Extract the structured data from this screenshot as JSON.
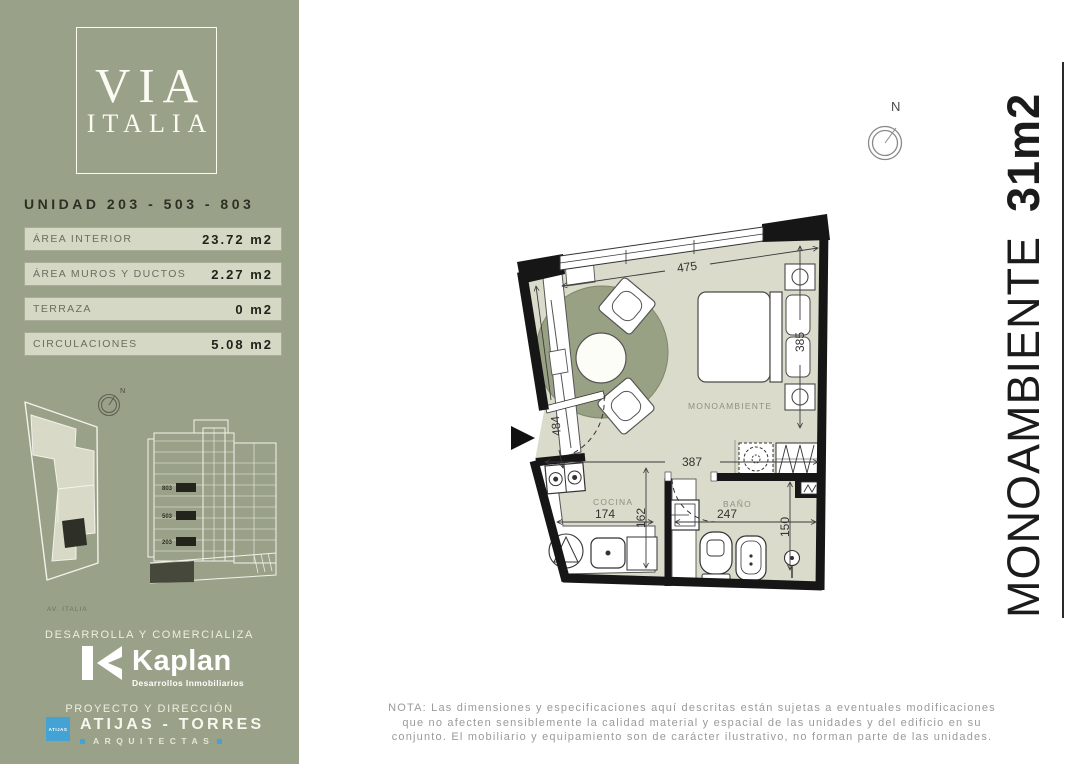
{
  "sidebar": {
    "logo": {
      "line1": "VIA",
      "line2": "ITALIA"
    },
    "unit_title": "UNIDAD 203 - 503 - 803",
    "areas": [
      {
        "label": "ÁREA INTERIOR",
        "value": "23.72 m2"
      },
      {
        "label": "ÁREA MUROS Y DUCTOS",
        "value": "2.27 m2"
      },
      {
        "label": "TERRAZA",
        "value": "0 m2"
      },
      {
        "label": "CIRCULACIONES",
        "value": "5.08 m2"
      }
    ],
    "site": {
      "compass": "N",
      "street": "AV. ITALIA"
    },
    "elevation": {
      "floors": [
        "803",
        "503",
        "203"
      ]
    },
    "developer": {
      "heading": "DESARROLLA Y COMERCIALIZA",
      "brand": "Kaplan",
      "tagline": "Desarrollos Inmobiliarios"
    },
    "architects": {
      "heading": "PROYECTO Y DIRECCIÓN",
      "badge": "ATIJAS",
      "name": "ATIJAS - TORRES",
      "subtitle": "ARQUITECTAS"
    }
  },
  "main": {
    "compass": "N",
    "side_title": {
      "text": "MONOAMBIENTE",
      "bold": "31m2"
    },
    "plan": {
      "rooms": {
        "main": "MONOAMBIENTE",
        "kitchen": "COCINA",
        "bath": "BAÑO"
      },
      "dims": {
        "top": "475",
        "left": "484",
        "mid": "387",
        "kitchen_w": "174",
        "kitchen_h": "162",
        "bath_w": "247",
        "bath_h": "150",
        "bed": "385"
      }
    },
    "note": {
      "line1": "NOTA: Las dimensiones y especificaciones aquí descritas están sujetas a eventuales modificaciones",
      "line2": "que no afecten sensiblemente la calidad material y espacial de las unidades y del edificio en su",
      "line3": "conjunto. El mobiliario y equipamiento son de carácter ilustrativo, no forman parte de las unidades."
    }
  },
  "colors": {
    "sidebar_green": "#9aa189",
    "row_bg": "#d6d8c6",
    "floor": "#dadbca",
    "rug": "#99a184",
    "wall": "#161616",
    "accent_blue": "#45a2d4"
  }
}
